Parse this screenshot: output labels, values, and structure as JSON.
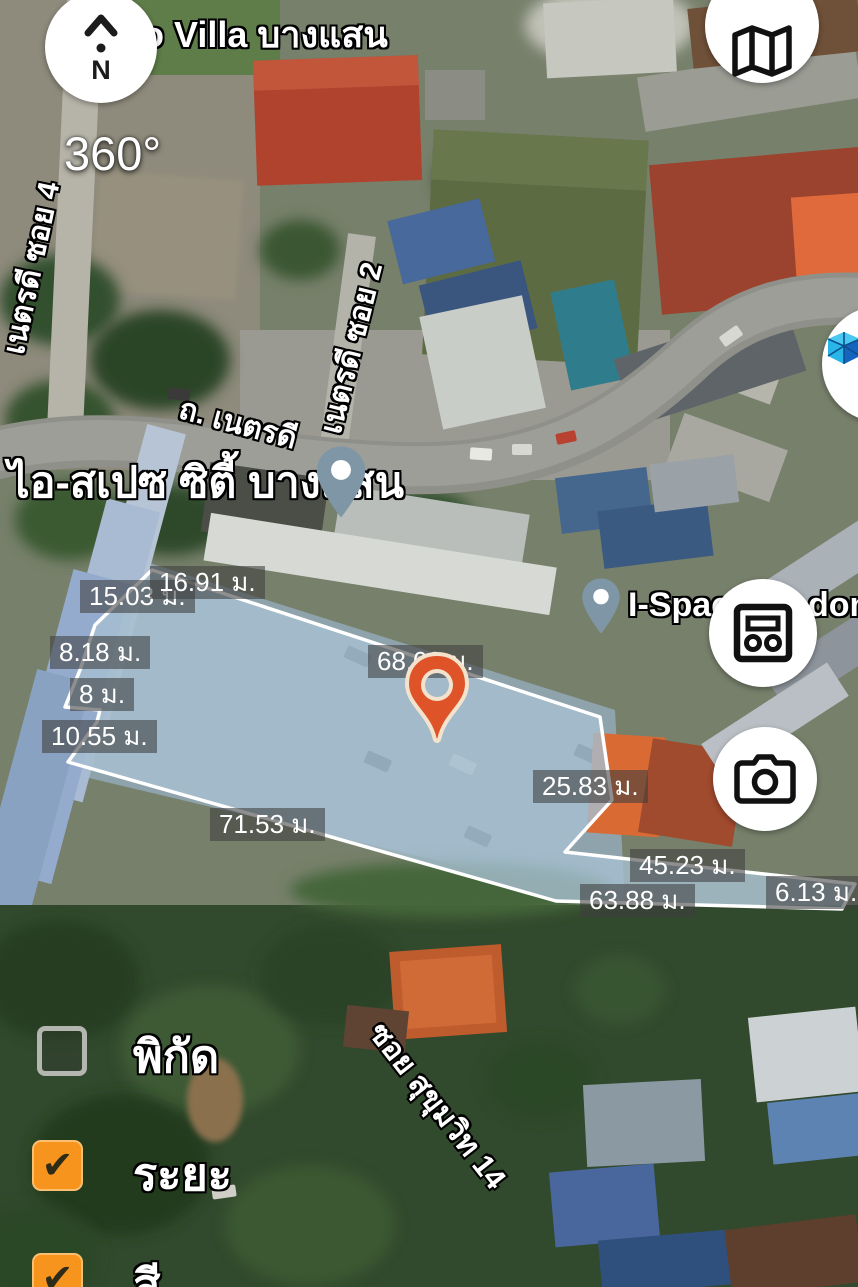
{
  "labels": {
    "villa": "o Villa บางแสน",
    "view360": "360°",
    "compass_n": "N",
    "ispace_city": "ไอ-สเปซ ซิตี้ บางแสน",
    "ispace_frag_left": "I-Spac",
    "ispace_frag_right": "dom",
    "road_netradee": "ถ. เนตรดี",
    "soi4": "เนตรดี ซอย 4",
    "soi2": "เนตรดี ซอย 2",
    "sukhumvit14": "ซอย สุขุมวิท 14"
  },
  "measurements": [
    {
      "text": "15.03 ม."
    },
    {
      "text": "16.91 ม."
    },
    {
      "text": "8.18 ม."
    },
    {
      "text": "8 ม."
    },
    {
      "text": "10.55 ม."
    },
    {
      "text": "68.03 ม."
    },
    {
      "text": "25.83 ม."
    },
    {
      "text": "71.53 ม."
    },
    {
      "text": "45.23 ม."
    },
    {
      "text": "63.88 ม."
    },
    {
      "text": "6.13 ม."
    }
  ],
  "menu": {
    "check_glyph": "✔",
    "items": [
      {
        "label": "พิกัด",
        "checked": false
      },
      {
        "label": "ระยะ",
        "checked": true
      },
      {
        "label": "สี",
        "checked": true
      }
    ]
  },
  "icons": {
    "compass": "north-compass",
    "map": "folded-map",
    "cube3d": "3d-cube",
    "panel": "measure-display-panel",
    "camera": "camera"
  },
  "colors": {
    "accent_orange": "#F6941E",
    "pin_orange": "#DF5329",
    "pin_grey": "#7E96A5",
    "plot_fill": "#A6BFD1",
    "plot_stroke": "#FFFFFF",
    "chip_bg": "rgba(62,62,62,0.58)"
  }
}
